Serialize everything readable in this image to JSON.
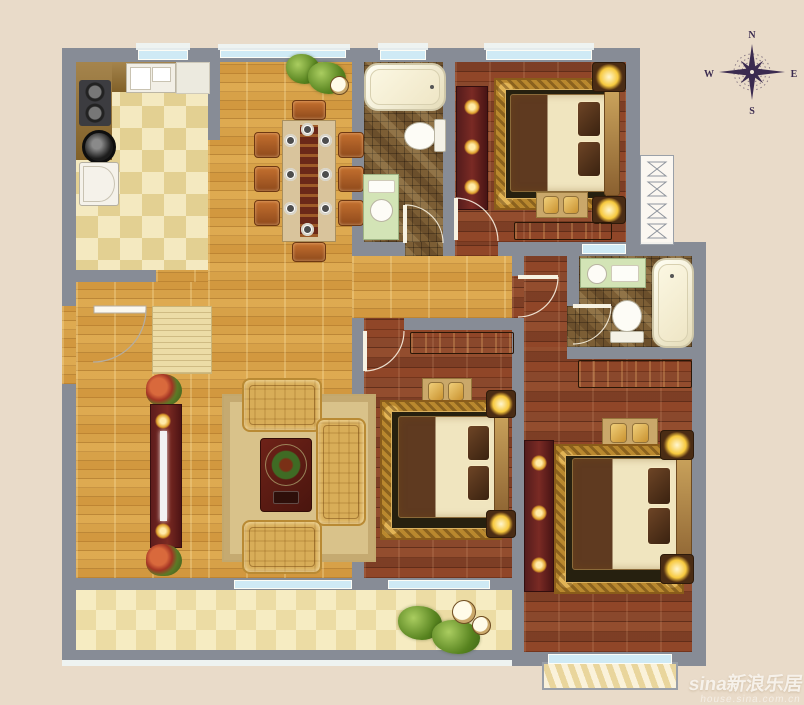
{
  "compass": {
    "north": "N",
    "south": "S",
    "east": "E",
    "west": "W"
  },
  "watermark": {
    "brand": "sina新浪乐居",
    "url": "house.sina.com.cn"
  },
  "palette": {
    "bg": "#e9dbc9",
    "wall": "#878c96",
    "window": "#cfeaf5",
    "woodGold": "#d7a148",
    "woodRed": "#8a482c",
    "tileLight": "#f4e9c0",
    "tileDark": "#e3d092",
    "mosaic": "#7c5e35",
    "cream": "#f0e5bf",
    "glow": "#f7c93e",
    "rug": "#d9c28a",
    "compassInk": "#3b2b50",
    "watermark": "#ffffff"
  }
}
